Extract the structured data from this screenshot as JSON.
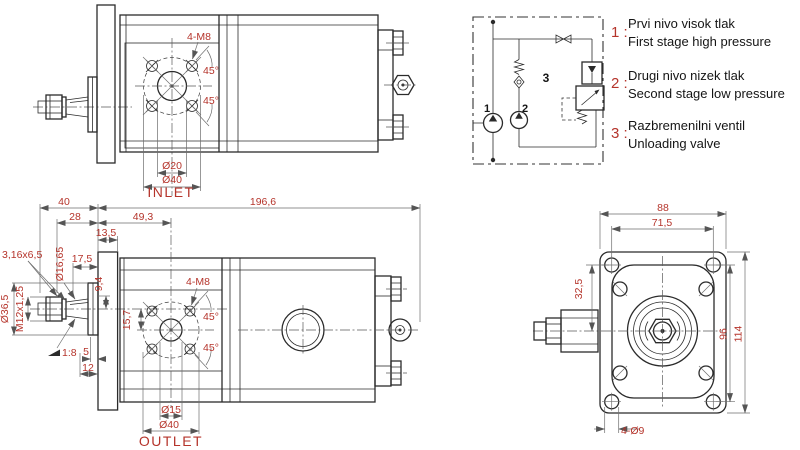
{
  "colors": {
    "dimension_red": "#b5342b",
    "line_dark": "#2b2b2b",
    "background": "#ffffff"
  },
  "top_view": {
    "bolt_note": "4-M8",
    "angle_upper": "45°",
    "angle_lower": "45°",
    "port_diameter": "Ø20",
    "bolt_circle_diameter": "Ø40",
    "port_label": "INLET"
  },
  "side_view": {
    "shaft_length": "40",
    "nut_length": "28",
    "port_distance": "49,3",
    "total_length": "196,6",
    "flange_thickness": "13,5",
    "key_size": "3,16x6,5",
    "taper_diameter": "Ø16,65",
    "shaft_protrusion": "17,5",
    "key_dim": "9,4",
    "pilot_diameter": "Ø36,5",
    "thread": "M12x1,25",
    "port_offset": "15,7",
    "taper_ratio": "1:8",
    "step_5": "5",
    "step_12": "12",
    "bolt_note": "4-M8",
    "angle_upper": "45°",
    "angle_lower": "45°",
    "port_diameter": "Ø15",
    "bolt_circle_diameter": "Ø40",
    "port_label": "OUTLET"
  },
  "front_view": {
    "width": "88",
    "hole_spacing_h": "71,5",
    "center_offset": "32,5",
    "hole_spacing_v": "96",
    "height": "114",
    "mount_holes": "4-Ø9"
  },
  "schematic": {
    "pump1": "1",
    "pump2": "2",
    "valve": "3"
  },
  "legend": [
    {
      "num": "1 :",
      "line1": "Prvi nivo visok tlak",
      "line2": "First stage high pressure"
    },
    {
      "num": "2 :",
      "line1": "Drugi nivo nizek tlak",
      "line2": "Second stage low pressure"
    },
    {
      "num": "3 :",
      "line1": "Razbremenilni ventil",
      "line2": "Unloading valve"
    }
  ]
}
